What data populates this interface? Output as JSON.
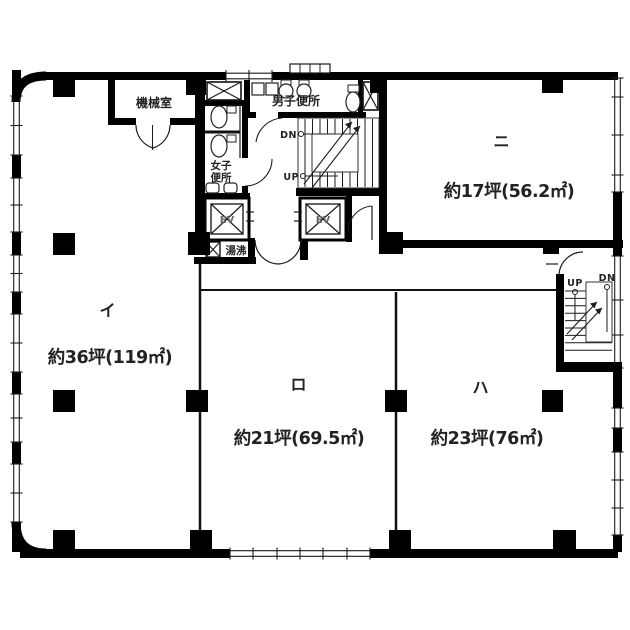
{
  "plan": {
    "units": [
      {
        "id": "i",
        "name": "イ",
        "area": "約36坪(119㎡)"
      },
      {
        "id": "ro",
        "name": "ロ",
        "area": "約21坪(69.5㎡)"
      },
      {
        "id": "ha",
        "name": "ハ",
        "area": "約23坪(76㎡)"
      },
      {
        "id": "ni",
        "name": "ニ",
        "area": "約17坪(56.2㎡)"
      }
    ],
    "facilities": {
      "machine_room": "機械室",
      "mens_toilet": "男子便所",
      "womens_toilet_line1": "女子",
      "womens_toilet_line2": "便所",
      "hot_water_room": "湯沸",
      "elevator_left": "EV",
      "elevator_right": "EV"
    },
    "stairs_center": {
      "down": "DN",
      "up": "UP"
    },
    "stairs_right": {
      "up": "UP",
      "down": "DN"
    },
    "colors": {
      "wall": "#000000",
      "line": "#1c1c1c",
      "text": "#222222",
      "background": "#ffffff"
    }
  }
}
